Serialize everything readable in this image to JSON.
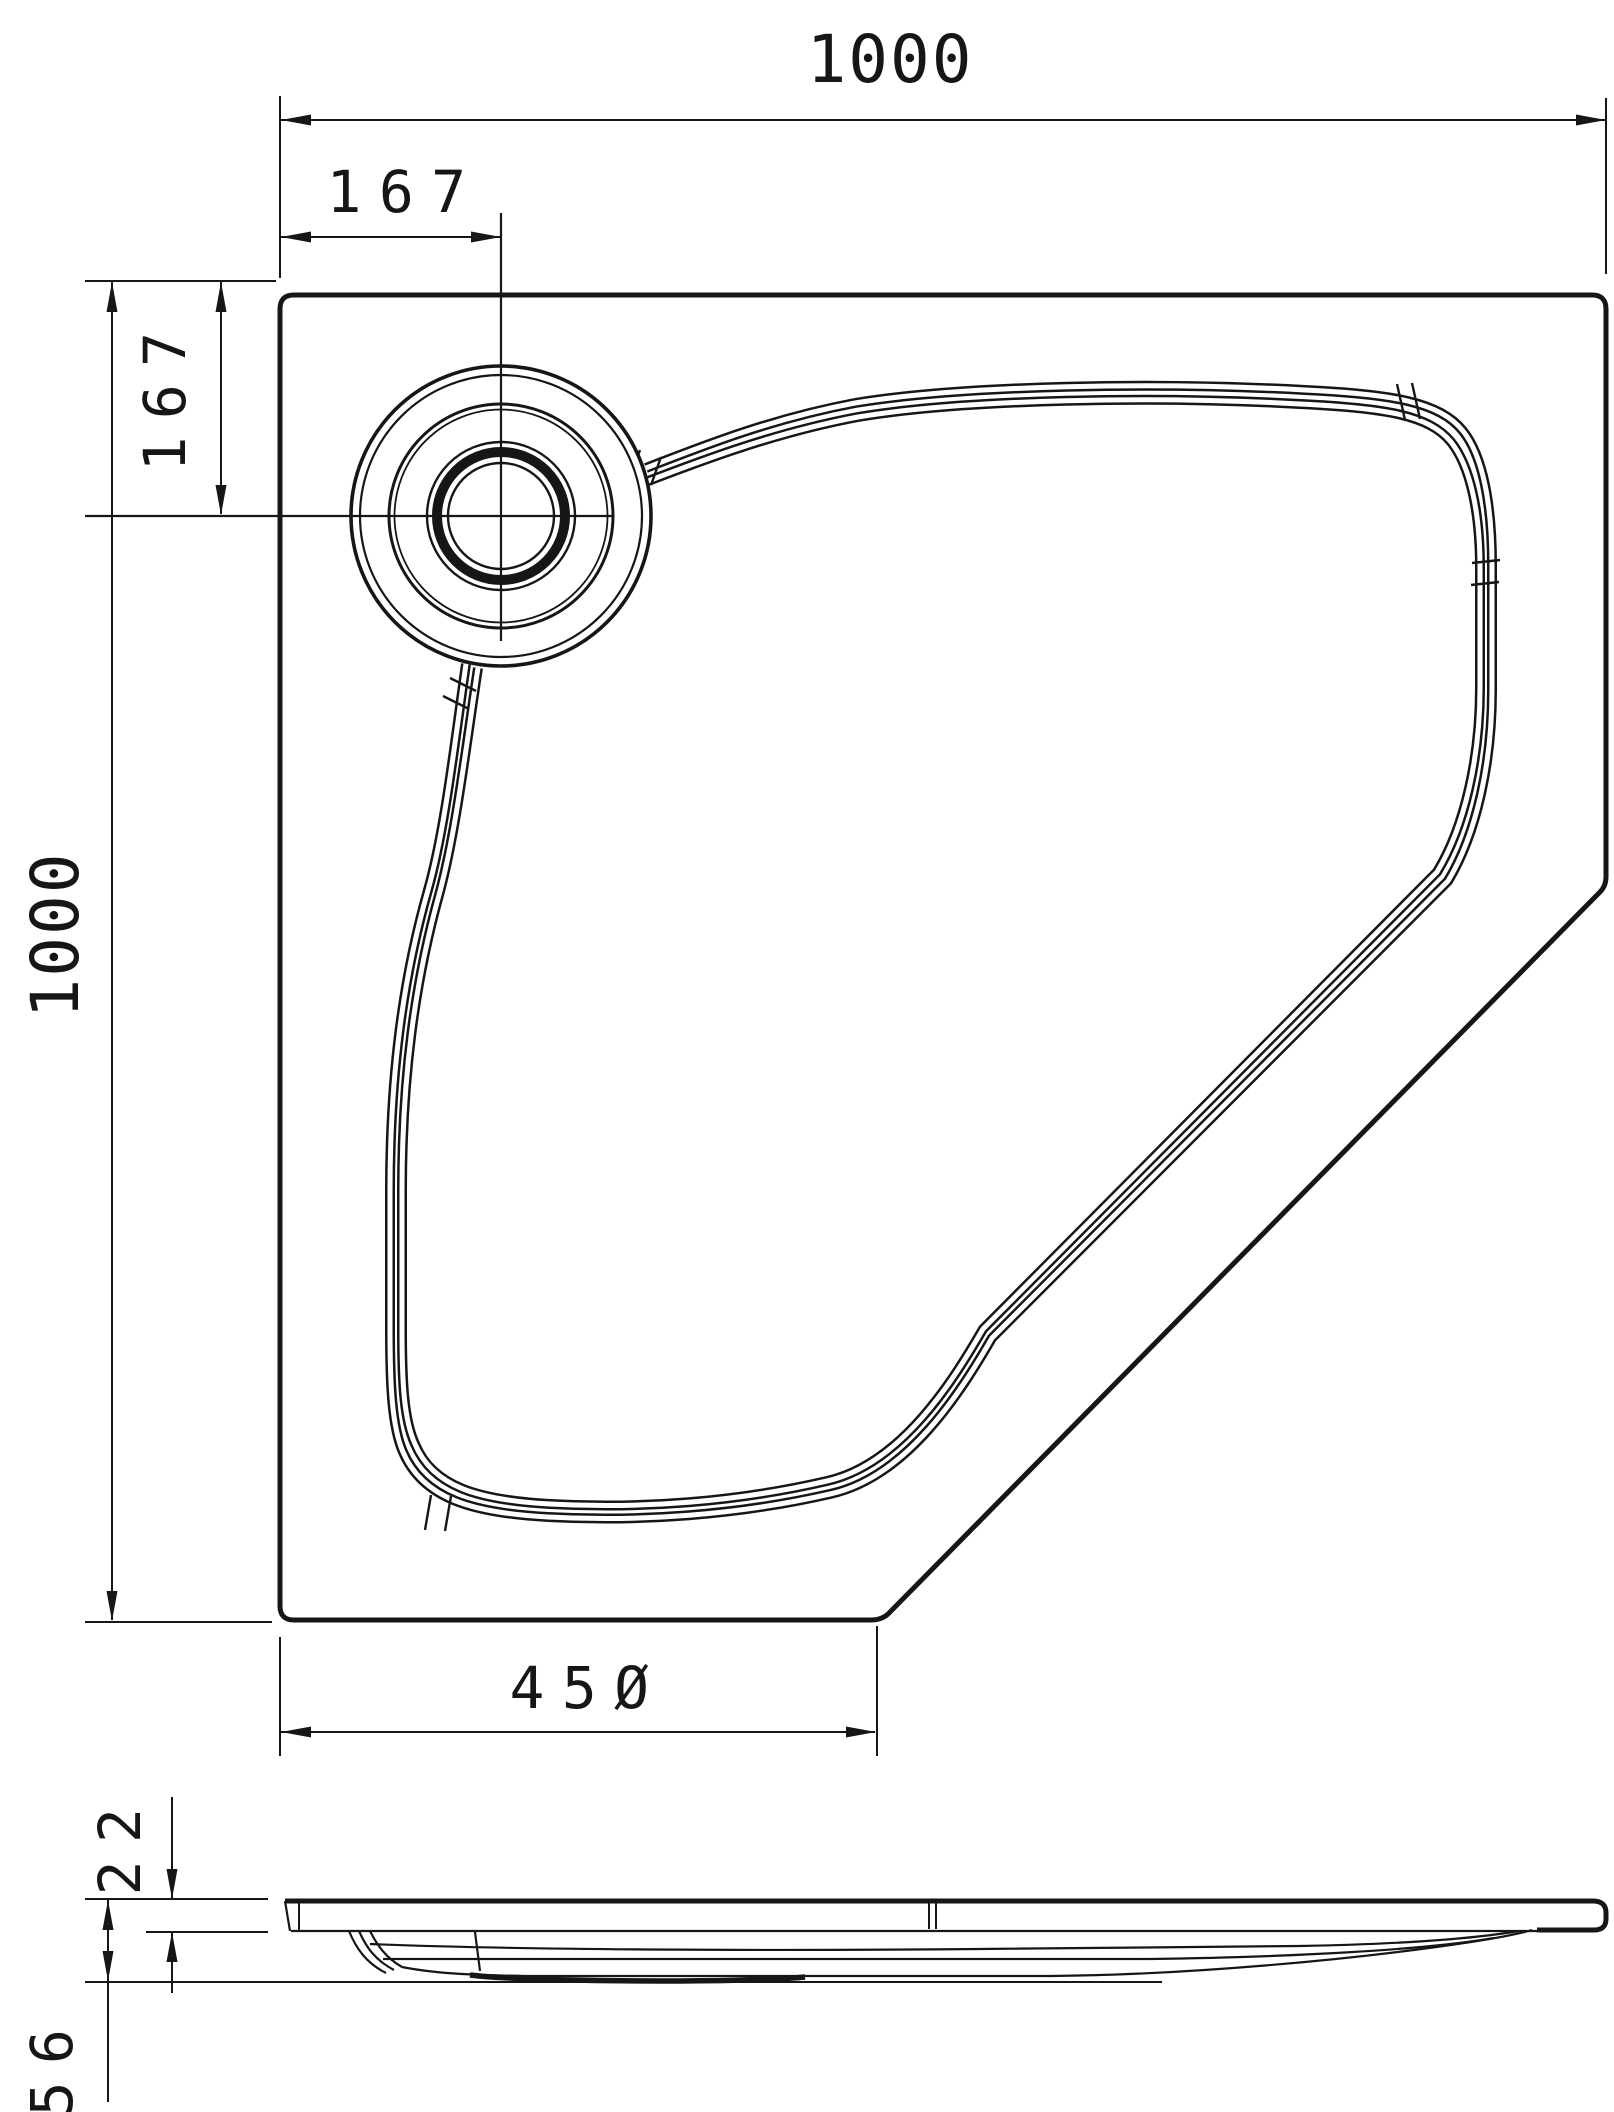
{
  "page": {
    "background_color": "#ffffff",
    "line_color": "#161616",
    "description": "Technical dimension drawing of a pentagonal shower tray, top plan view with drain detail and bottom section/side view"
  },
  "plan_view": {
    "dimensions": {
      "overall_width_top": {
        "label": "1000"
      },
      "drain_offset_horizontal": {
        "label": "167"
      },
      "overall_depth_left": {
        "label": "1000"
      },
      "drain_offset_vertical": {
        "label": "167"
      },
      "bottom_edge_length": {
        "label": "450",
        "display": "45Ø"
      }
    }
  },
  "side_view": {
    "dimensions": {
      "rim_thickness": {
        "label": "22"
      },
      "total_height": {
        "label": "56"
      }
    }
  }
}
